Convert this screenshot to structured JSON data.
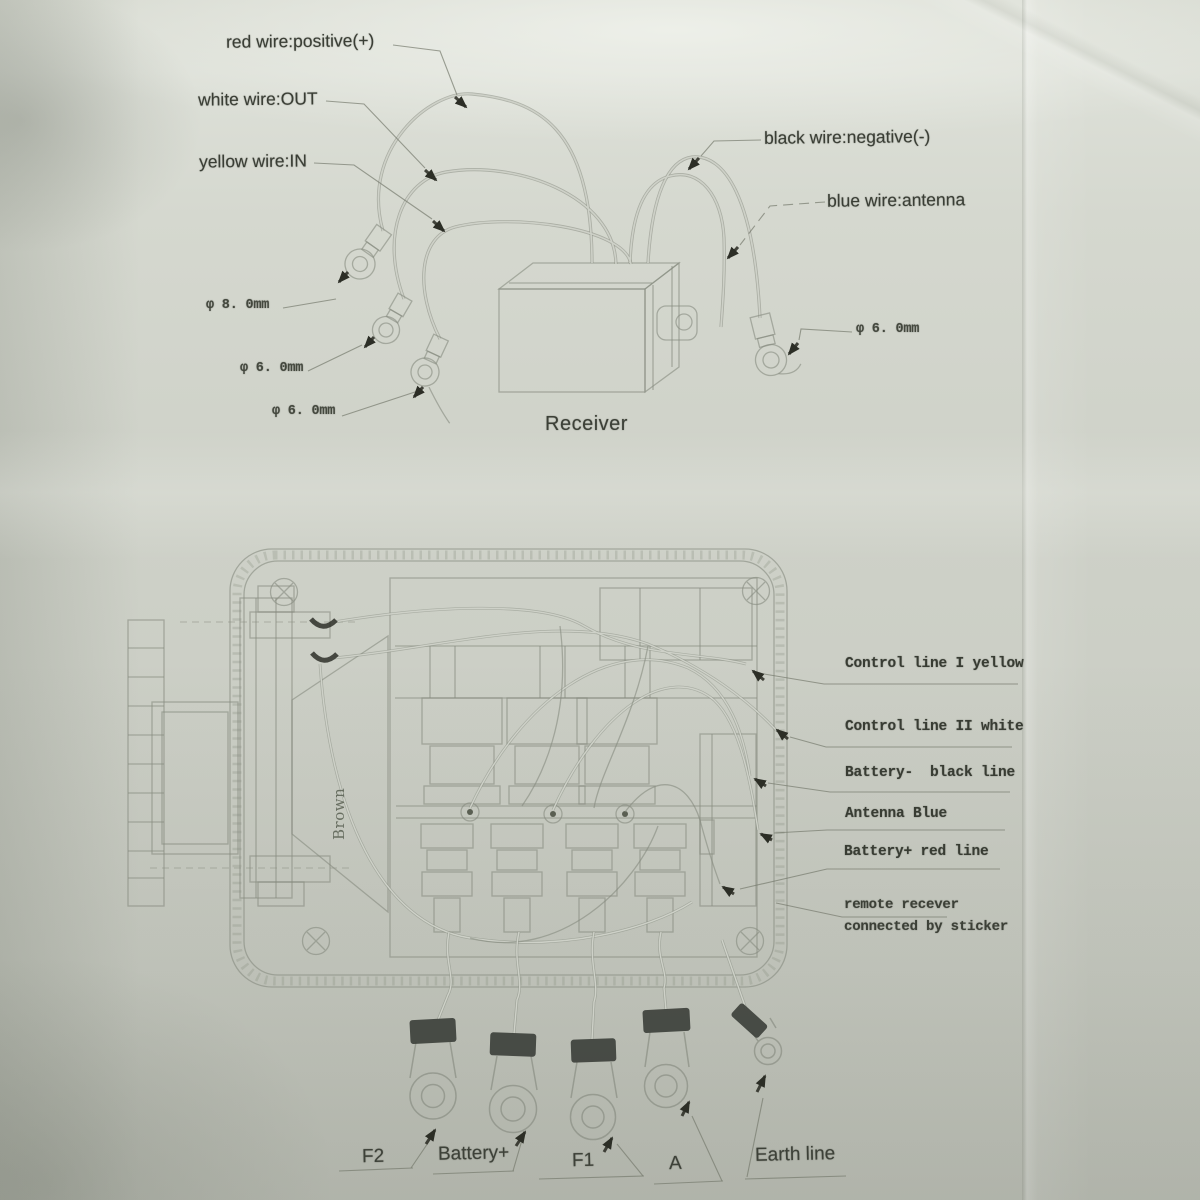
{
  "receiver_diagram": {
    "caption": "Receiver",
    "wire_labels": [
      "red wire:positive(+)",
      "white wire:OUT",
      "yellow wire:IN",
      "black wire:negative(-)",
      "blue wire:antenna"
    ],
    "gauge_labels": [
      "φ 8. 0mm",
      "φ 6. 0mm",
      "φ 6. 0mm",
      "φ 6. 0mm"
    ]
  },
  "control_box_diagram": {
    "line_labels": [
      "Control line I yellow",
      "Control line II white",
      "Battery-  black line",
      "Antenna Blue",
      "Battery+ red line"
    ],
    "note": [
      "remote recever",
      "connected by sticker"
    ],
    "internal_label": "Brown",
    "terminal_labels": [
      "F2",
      "Battery+",
      "F1",
      "A",
      "Earth line"
    ]
  },
  "colors": {
    "paper": "#ced1c8",
    "ink": "#3a3e35",
    "linework": "#868b7f",
    "shrink_tube": "#3b3e38"
  }
}
